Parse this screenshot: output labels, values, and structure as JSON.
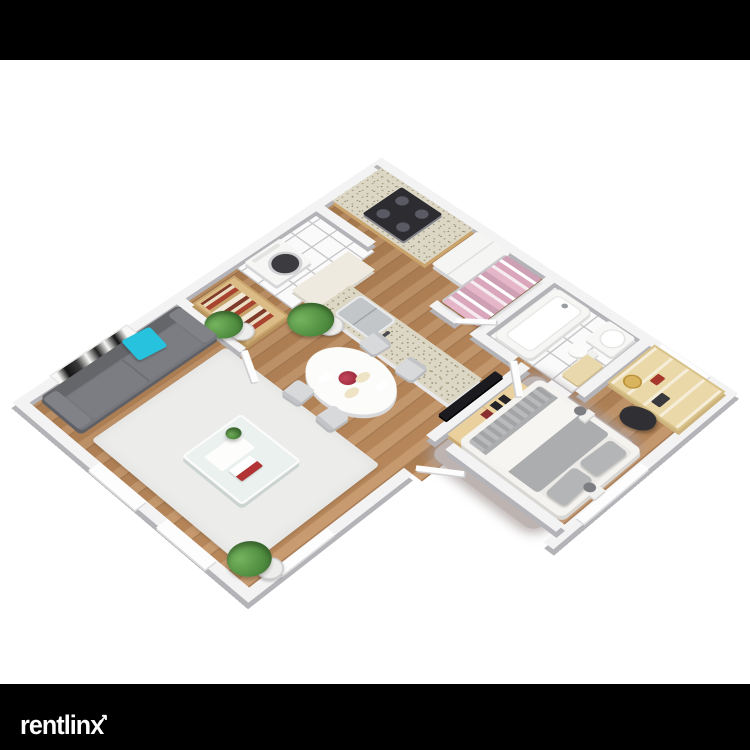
{
  "watermark": {
    "brand": "rentlinx",
    "arrow_glyph": "↗"
  },
  "image": {
    "type": "3D isometric apartment floor plan rendering (dollhouse top view)",
    "rooms": [
      "living room",
      "dining area",
      "kitchen",
      "laundry nook",
      "closet",
      "bathroom",
      "dressing area",
      "bedroom"
    ],
    "furniture": [
      "gray sofa with cyan accent pillow",
      "black-and-white abstract wall art",
      "potted plants",
      "white area rug",
      "glass coffee table with magazines",
      "oval dining table with four chairs",
      "bookshelf",
      "kitchen counter with gas stove and oven",
      "kitchen island with sink",
      "washing machine",
      "refrigerator",
      "wardrobe rail with pink clothes",
      "bathtub",
      "toilet",
      "vanity sink",
      "storage shelf with clock",
      "dark duffel bag",
      "double bed with gray-and-white bedding",
      "flat TV on media wall",
      "wooden dresser",
      "two bedside lamps",
      "gray shag rug"
    ],
    "palette": {
      "background": "#ffffff",
      "letterbox": "#000000",
      "wall_top": "#f3f3f4",
      "wall_face": "#b4b4b8",
      "wood_floor": "#b8895c",
      "tile_floor": "#fafafa",
      "sofa": "#75777c",
      "accent_pillow": "#27c2de",
      "bed_linen": "#acadaf",
      "cabinet_wood": "#dcbc86",
      "granite": "#dcd6c5",
      "clothes_pink": "#e5b6c8",
      "logo_text": "#ffffff"
    }
  }
}
